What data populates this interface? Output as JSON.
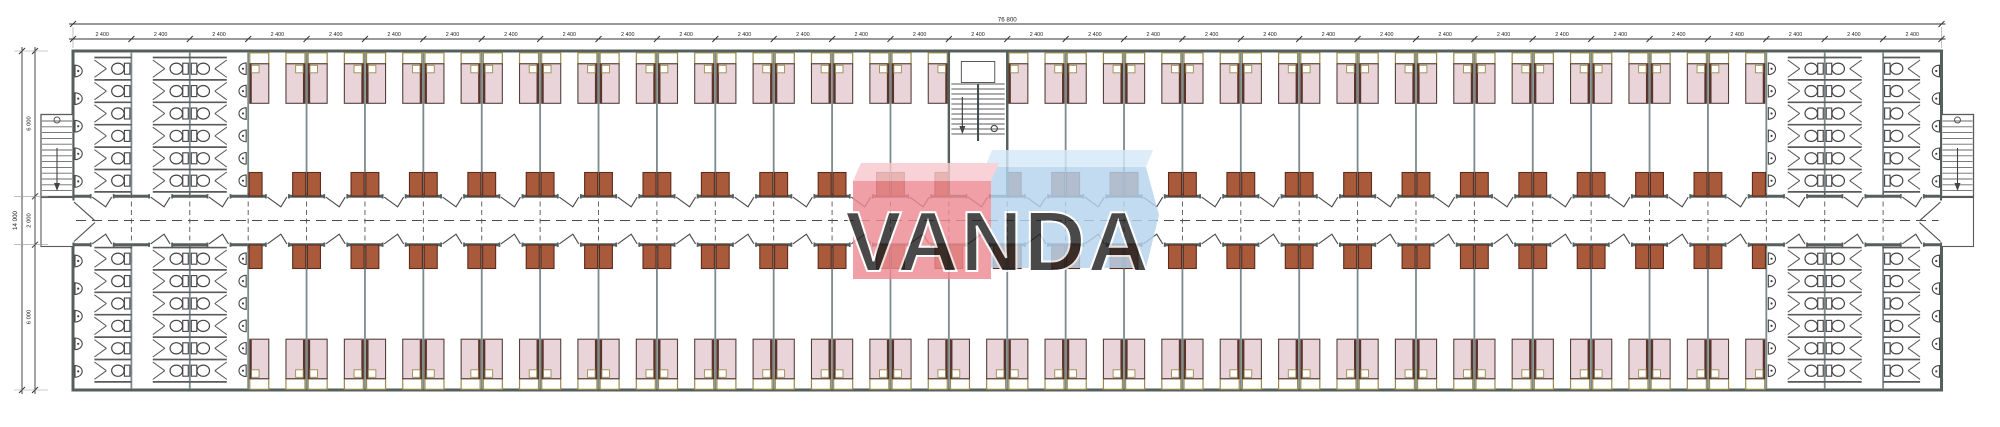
{
  "watermark": {
    "text": "VANDA",
    "red_front": "#ee8b93",
    "red_top": "#f7c9ce",
    "blue_front": "#b5d4ee",
    "blue_top": "#d6e9f8",
    "text_color": "#ffffff"
  },
  "dimensions": {
    "top_total_label": "76 800",
    "module_label": "2 400",
    "module_count": 32,
    "module_value_mm": 2400,
    "total_width_mm": 76800,
    "left_total_label": "14 000",
    "left_segment_labels": [
      "6 000",
      "2 000",
      "6 000"
    ],
    "left_segment_values_mm": [
      6000,
      2000,
      6000
    ],
    "total_height_mm": 14000
  },
  "plan": {
    "module_count": 32,
    "corridor": {
      "position": "center",
      "width_mm": 2000
    },
    "stairwell": {
      "location": "top-row-center",
      "module_index": 15
    },
    "external_stairs": [
      "west-end",
      "east-end"
    ],
    "sanitary_blocks": [
      {
        "location": "west-top",
        "modules": 3,
        "toilets": 18,
        "sinks": 11
      },
      {
        "location": "west-bottom",
        "modules": 3,
        "toilets": 18,
        "sinks": 11
      },
      {
        "location": "east-top",
        "modules": 3,
        "toilets": 18,
        "sinks": 11
      },
      {
        "location": "east-bottom",
        "modules": 3,
        "toilets": 18,
        "sinks": 11
      }
    ],
    "fixtures_per_block": {
      "toilet_columns": 3,
      "toilets_per_column": 6,
      "outer_wall_sinks": 5,
      "inner_wall_sinks": 6
    },
    "rooms": {
      "top_row": 25,
      "bottom_row": 26,
      "beds_per_room": 2,
      "lockers_per_room": 2,
      "beds_total": 102
    },
    "colors": {
      "background": "#ffffff",
      "outer_wall": "#55605c",
      "wall": "#7b8a8a",
      "bed_fill": "#e9d4da",
      "bed_border": "#54413b",
      "bed_head_border": "#9c8b4d",
      "pillow_fill": "#ffffff",
      "locker_fill": "#a85a3a",
      "locker_border": "#5f2b1d",
      "fixture_line": "#444444",
      "dash_line": "#4a4a4a",
      "dim_line": "#333333"
    }
  }
}
